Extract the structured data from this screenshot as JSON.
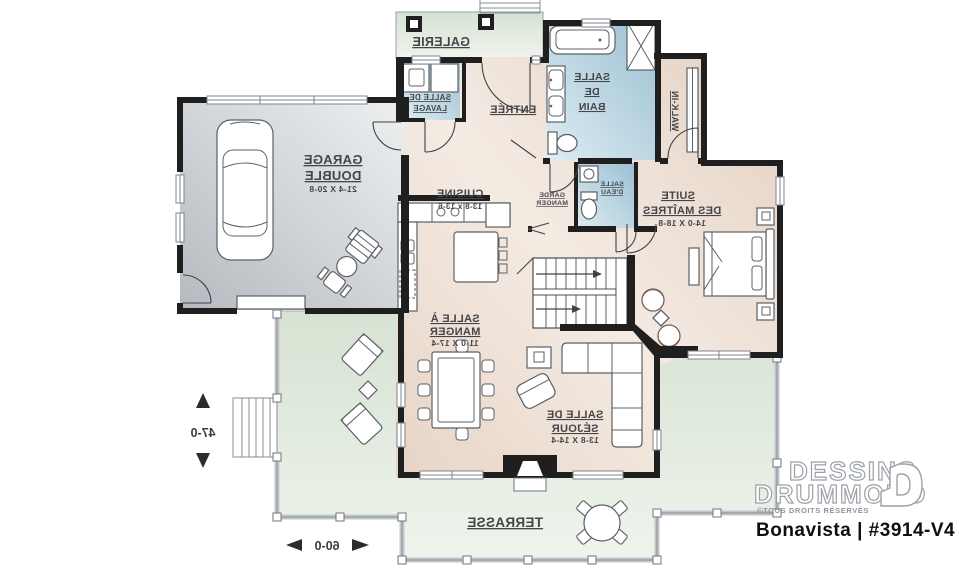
{
  "branding": {
    "brand_line1": "DESSINS",
    "brand_line2": "DRUMMOND",
    "copyright": "©TOUS DROITS RÉSERVÉS",
    "plan_label": "Bonavista | #3914-V4"
  },
  "plan": {
    "orientation": "reversed-mirror",
    "overall_width": "60-0",
    "overall_depth": "47-0",
    "rooms": {
      "galerie": {
        "name": "GALERIE"
      },
      "laundry": {
        "name1": "SALLE DE",
        "name2": "LAVAGE"
      },
      "entree": {
        "name": "ENTRÉE"
      },
      "bath": {
        "name1": "SALLE",
        "name2": "DE",
        "name3": "BAIN"
      },
      "walkin": {
        "name": "WALK-IN"
      },
      "garage": {
        "name1": "GARAGE",
        "name2": "DOUBLE",
        "dims": "21-4 X 20-8"
      },
      "cuisine": {
        "name": "CUISINE",
        "dims": "13-8 x 13-6"
      },
      "pantry": {
        "name1": "GARDE",
        "name2": "MANGER"
      },
      "powder": {
        "name1": "SALLE",
        "name2": "D'EAU"
      },
      "suite": {
        "name1": "SUITE",
        "name2": "DES MAÎTRES",
        "dims": "14-0 X 18-8"
      },
      "dining": {
        "name1": "SALLE À",
        "name2": "MANGER",
        "dims": "11-0 X 17-4"
      },
      "living": {
        "name1": "SALLE DE",
        "name2": "SÉJOUR",
        "dims": "13-8 X 14-4"
      },
      "terrasse": {
        "name": "TERRASSE"
      }
    }
  },
  "colors": {
    "wall": "#1f1f1f",
    "floor_beige": "#ead9cc",
    "wet_room_blue": "#a9c8d8",
    "outdoor_green": "#dbe6d7",
    "garage_gray": "#c5cacd",
    "label_text": "#45464a"
  }
}
